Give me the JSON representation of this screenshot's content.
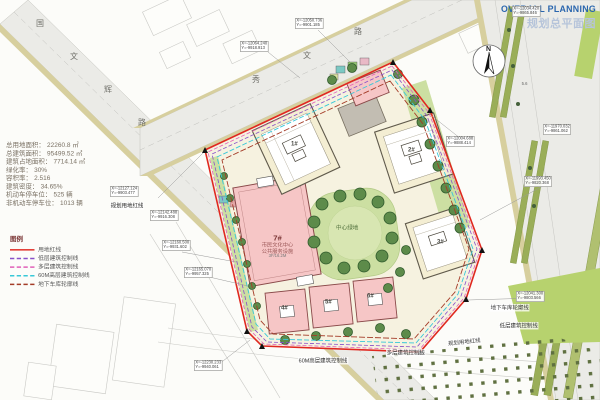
{
  "header": {
    "title_en": "OVERALL PLANNING",
    "title_zh": "规划总平面图"
  },
  "stats": {
    "rows": [
      {
        "label": "总用地面积：",
        "value": "22260.8 ㎡"
      },
      {
        "label": "总建筑面积：",
        "value": "95499.52 ㎡"
      },
      {
        "label": "建筑占地面积：",
        "value": "7714.14 ㎡"
      },
      {
        "label": "绿化率：",
        "value": "30%"
      },
      {
        "label": "容积率：",
        "value": "2.516"
      },
      {
        "label": "建筑密度：",
        "value": "34.65%"
      },
      {
        "label": "机动车停车位：",
        "value": "525 辆"
      },
      {
        "label": "非机动车停车位：",
        "value": "1013 辆"
      }
    ]
  },
  "legend": {
    "header": "图例",
    "items": [
      {
        "label": "用地红线",
        "color": "#e02820",
        "line_style": "solid"
      },
      {
        "label": "低层建筑控制线",
        "color": "#8850c8",
        "line_style": "dashed"
      },
      {
        "label": "多层建筑控制线",
        "color": "#e060b8",
        "line_style": "dashed"
      },
      {
        "label": "60M高层建筑控制线",
        "color": "#38c8d8",
        "line_style": "dashed"
      },
      {
        "label": "地下车库轮廓线",
        "color": "#a43c28",
        "line_style": "dashed"
      }
    ]
  },
  "roads": {
    "left": {
      "name": "国文辉路",
      "chars": [
        "国",
        "文",
        "辉",
        "路"
      ]
    },
    "top": {
      "name": "秀文路",
      "chars": [
        "秀",
        "文",
        "路"
      ]
    }
  },
  "north": {
    "label": "N"
  },
  "park": {
    "label": "中心绿地"
  },
  "buildings": {
    "b1": {
      "id": "1#"
    },
    "b2": {
      "id": "2#"
    },
    "b3": {
      "id": "3#"
    },
    "b4": {
      "id": "4#"
    },
    "b5": {
      "id": "5#"
    },
    "b6": {
      "id": "6#"
    },
    "b7": {
      "id": "7#",
      "line1": "市民文化中心",
      "line2": "公共服务设施",
      "note": "3F/16.2M"
    }
  },
  "annotations": {
    "red_line_left": "规划用地红线",
    "red_line_right": "规划用地红线",
    "garage_outline": "地下车库轮廓线",
    "lowrise_control": "低层建筑控制线",
    "multi_control": "多层建筑控制线",
    "highrise_control": "60M高层建筑控制线",
    "spot_height": "5.6"
  },
  "coords": [
    {
      "x": "X=-12064.240",
      "y": "Y=-9918.913"
    },
    {
      "x": "X=-12050.736",
      "y": "Y=-9901.185"
    },
    {
      "x": "X=-12034.420",
      "y": "Y=-9865.846"
    },
    {
      "x": "X=-12004.688",
      "y": "Y=-9888.414"
    },
    {
      "x": "X=-11970.032",
      "y": "Y=-9861.062"
    },
    {
      "x": "X=-11993.450",
      "y": "Y=-9820.368"
    },
    {
      "x": "X=-12041.300",
      "y": "Y=-9803.566"
    },
    {
      "x": "X=-12127.124",
      "y": "Y=-9903.477"
    },
    {
      "x": "X=-12142.488",
      "y": "Y=-9916.308"
    },
    {
      "x": "X=-12160.500",
      "y": "Y=-9931.602"
    },
    {
      "x": "X=-12165.070",
      "y": "Y=-9957.325"
    },
    {
      "x": "X=-12230.233",
      "y": "Y=-9940.061"
    }
  ],
  "colors": {
    "boundary_red": "#e02820",
    "lowrise_purple": "#8850c8",
    "multistory_magenta": "#e060b8",
    "highrise_cyan": "#38c8d8",
    "garage_brown": "#a43c28",
    "title_blue": "#2a66ae",
    "subtitle_blue": "#b6c4da"
  }
}
